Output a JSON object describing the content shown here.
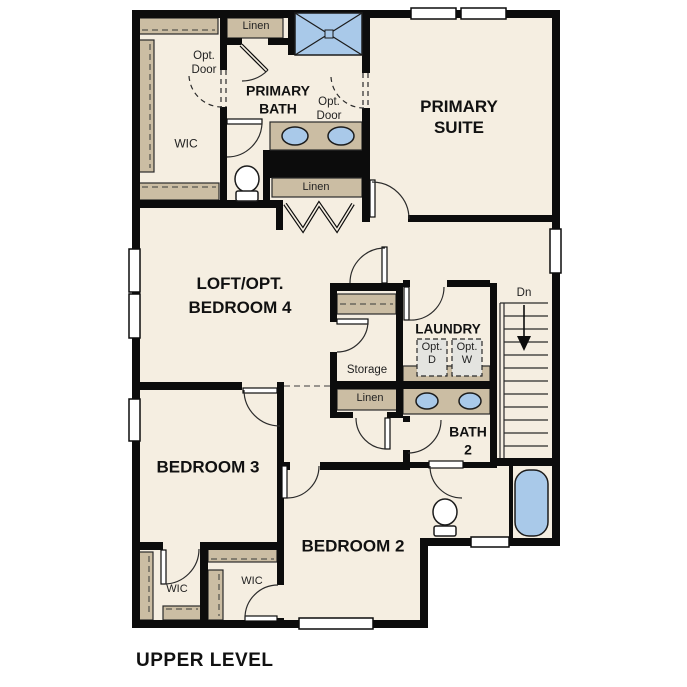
{
  "title": "UPPER LEVEL",
  "colors": {
    "floor": "#f5eee1",
    "wall": "#0c0c0c",
    "closet_tan": "#cbbda3",
    "fixture_blue": "#a9c9e9",
    "appliance_gray": "#e4e4e0"
  },
  "rooms": {
    "primary_suite": "PRIMARY\nSUITE",
    "primary_bath": "PRIMARY\nBATH",
    "loft": "LOFT/OPT.\nBEDROOM 4",
    "bedroom3": "BEDROOM 3",
    "bedroom2": "BEDROOM 2",
    "laundry": "LAUNDRY",
    "bath2": "BATH\n2"
  },
  "closets": {
    "wic_primary": "WIC",
    "wic_bedroom3": "WIC",
    "wic_bedroom2": "WIC",
    "storage": "Storage",
    "linen_top": "Linen",
    "linen_bath": "Linen",
    "linen_hall": "Linen"
  },
  "annotations": {
    "opt_door_wic": "Opt.\nDoor",
    "opt_door_bath": "Opt.\nDoor",
    "opt_dryer": "Opt.\nD",
    "opt_washer": "Opt.\nW",
    "stairs_down": "Dn"
  }
}
